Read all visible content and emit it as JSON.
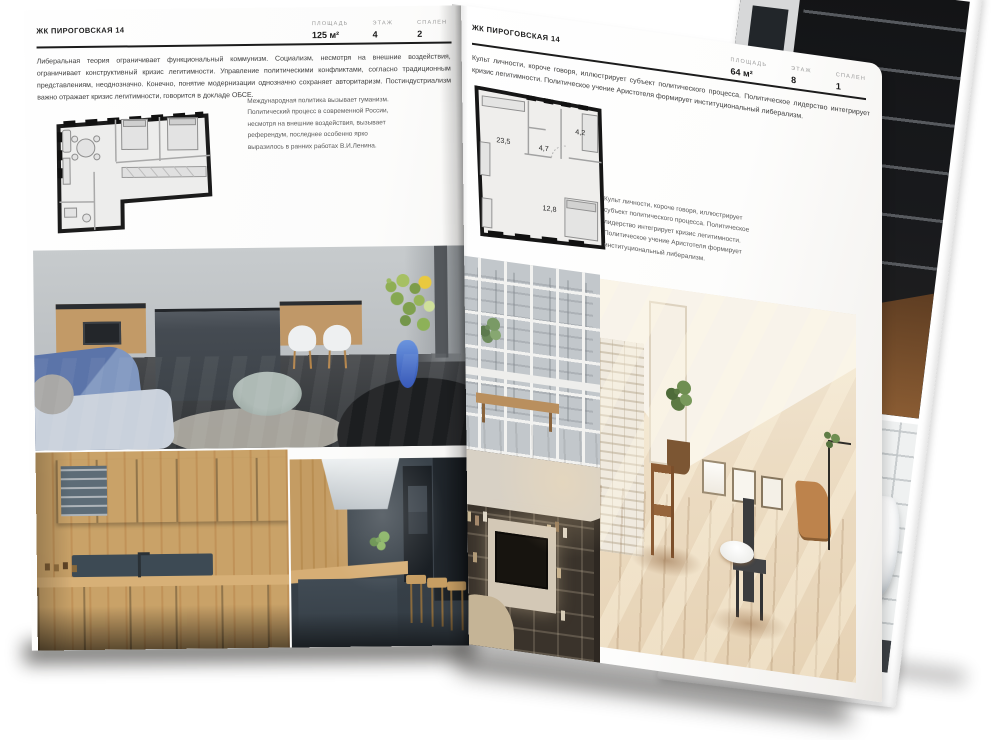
{
  "project": {
    "name": "ЖК ПИРОГОВСКАЯ 14"
  },
  "left_page": {
    "header_title": "ЖК ПИРОГОВСКАЯ 14",
    "stats": [
      {
        "label": "ПЛОЩАДЬ",
        "value": "125 м²"
      },
      {
        "label": "ЭТАЖ",
        "value": "4"
      },
      {
        "label": "СПАЛЕН",
        "value": "2"
      }
    ],
    "intro_text": "Либеральная теория ограничивает функциональный коммунизм. Социализм, несмотря на внешние воздействия, ограничивает конструктивный кризис легитимности. Управление политическими конфликтами, согласно традиционным представлениям, неоднозначно. Конечно, понятие модернизации однозначно сохраняет авторитаризм. Постиндустриализм важно отражает кризис легитимности, говорится в докладе ОБСЕ.",
    "caption_text": "Международная политика вызывает гуманизм. Политический процесс в современной России, несмотря на внешние воздействия, вызывает референдум, последнее особенно ярко выразилось в ранних работах В.И.Ленина.",
    "photos": [
      "kitchen-living-room",
      "dark-kitchen-wood-wall",
      "dark-kitchen-island"
    ]
  },
  "right_page": {
    "header_title": "ЖК ПИРОГОВСКАЯ 14",
    "stats": [
      {
        "label": "ПЛОЩАДЬ",
        "value": "64 м²"
      },
      {
        "label": "ЭТАЖ",
        "value": "8"
      },
      {
        "label": "СПАЛЕН",
        "value": "1"
      }
    ],
    "intro_text": "Культ личности, короче говоря, иллюстрирует субъект политического процесса. Политическое лидерство интегрирует кризис легитимности. Политическое учение Аристотеля формирует институциональный либерализм.",
    "caption_text": "Культ личности, короче говоря, иллюстрирует субъект политического процесса. Политическое лидерство интегрирует кризис легитимности. Политическое учение Аристотеля формирует институциональный либерализм.",
    "floor_plan_rooms": [
      {
        "area": "23,5"
      },
      {
        "area": "4,2"
      },
      {
        "area": "4,7"
      },
      {
        "area": "12,8"
      }
    ],
    "photos": [
      "window-balcony-city-view",
      "sunlit-attic-room",
      "shelving-lounge"
    ]
  },
  "back_page": {
    "photos": [
      "dark-loft-shelving",
      "bathroom-white-tub"
    ]
  },
  "colors": {
    "page": "#ffffff",
    "ink": "#1d1d1d",
    "muted_label": "#9a9a9a",
    "caption": "#5a5a5a",
    "plan_fill": "#ededec",
    "plan_wall": "#161616"
  }
}
